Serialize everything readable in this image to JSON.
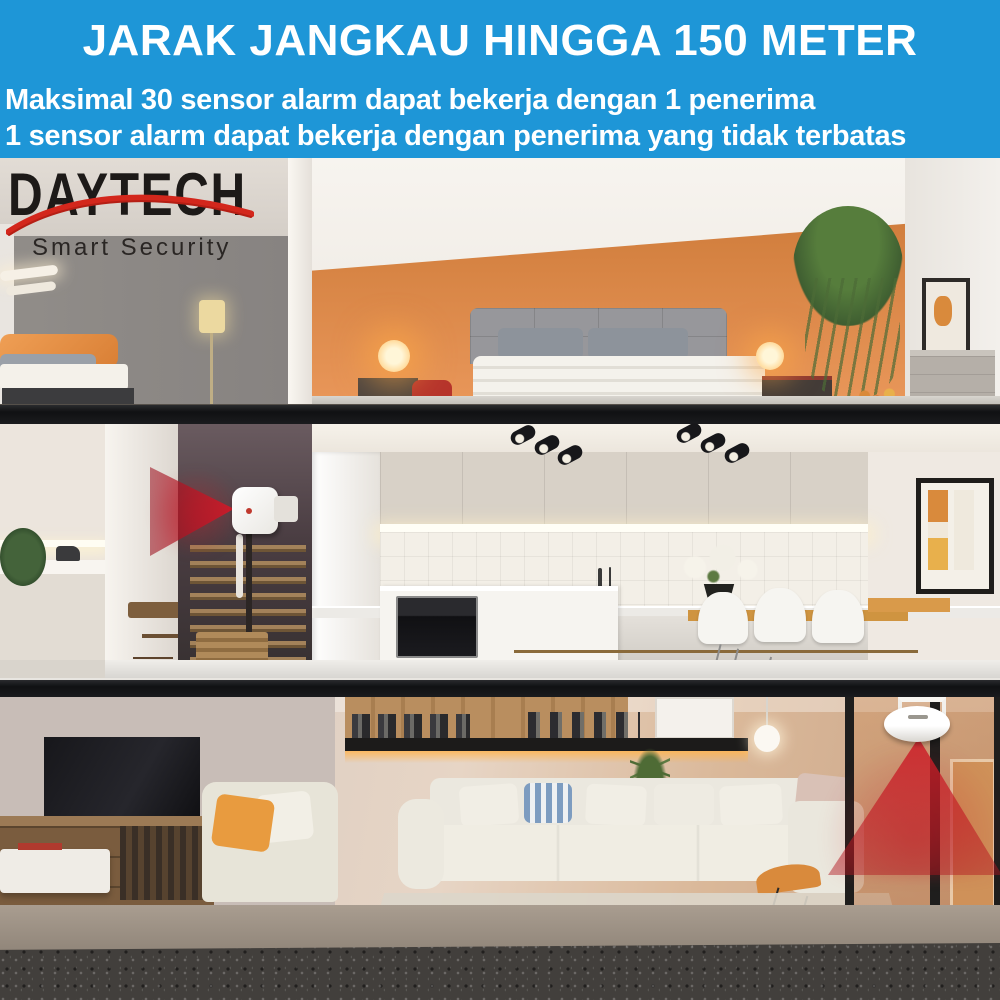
{
  "banner": {
    "bg_color": "#1e96d7",
    "text_color": "#ffffff",
    "title": "JARAK JANGKAU HINGGA 150 METER",
    "subtitle1": "Maksimal 30 sensor alarm dapat bekerja dengan 1 penerima",
    "subtitle2": "1 sensor alarm dapat bekerja dengan penerima yang tidak terbatas"
  },
  "logo": {
    "brand": "DAYTECH",
    "tagline": "Smart Security",
    "brand_color": "#1d1a18",
    "swoosh_color": "#d3271c"
  },
  "scene": {
    "type": "three-storey house cutaway photo",
    "sensors": [
      {
        "name": "wall-motion-sensor",
        "location": "staircase wall, middle floor",
        "beam_direction": "left",
        "beam_color": "#c8202c"
      },
      {
        "name": "ceiling-motion-sensor",
        "location": "living room ceiling near glass doors",
        "beam_direction": "down",
        "beam_color": "#c8202c"
      }
    ],
    "colors": {
      "bedroom_accent_wall": "#e08b4c",
      "floor_slab": "#141518",
      "carpet": "#423f3c",
      "kitchen_cabinets": "#d8d1c7",
      "sofa": "#f0ede3"
    }
  }
}
